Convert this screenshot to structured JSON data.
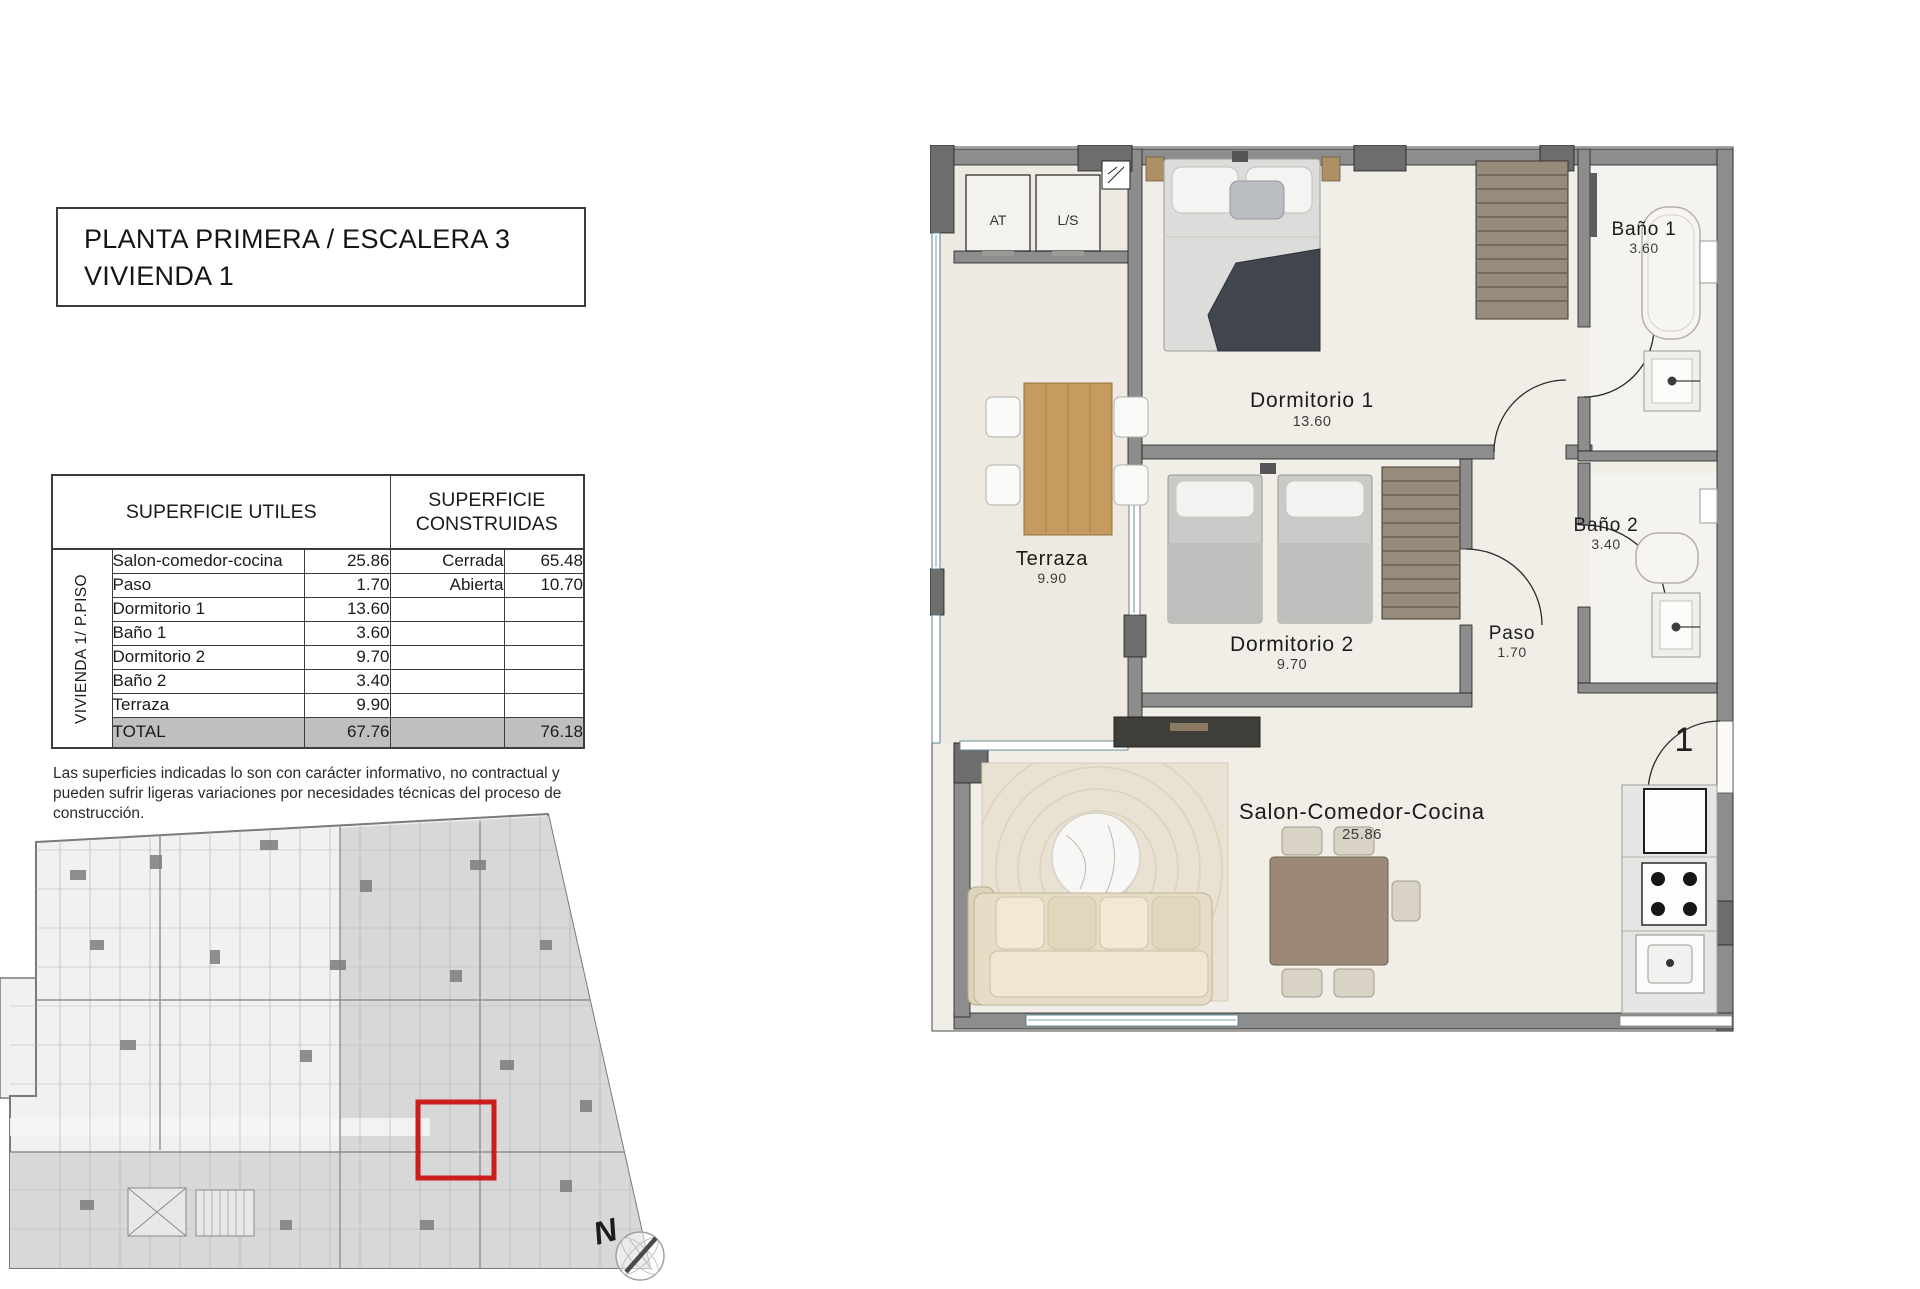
{
  "header": {
    "title_line1": "PLANTA PRIMERA / ESCALERA 3",
    "title_line2": "VIVIENDA 1"
  },
  "surfaces_table": {
    "utiles_header": "SUPERFICIE UTILES",
    "construidas_header": "SUPERFICIE CONSTRUIDAS",
    "group_label": "VIVIENDA 1/ P.PISO",
    "utiles_rows": [
      {
        "name": "Salon-comedor-cocina",
        "value": "25.86"
      },
      {
        "name": "Paso",
        "value": "1.70"
      },
      {
        "name": "Dormitorio 1",
        "value": "13.60"
      },
      {
        "name": "Baño 1",
        "value": "3.60"
      },
      {
        "name": "Dormitorio 2",
        "value": "9.70"
      },
      {
        "name": "Baño 2",
        "value": "3.40"
      },
      {
        "name": "Terraza",
        "value": "9.90"
      }
    ],
    "construidas_rows": [
      {
        "name": "Cerrada",
        "value": "65.48"
      },
      {
        "name": "Abierta",
        "value": "10.70"
      }
    ],
    "total": {
      "label": "TOTAL",
      "utiles": "67.76",
      "construidas": "76.18"
    }
  },
  "disclaimer": "Las superficies indicadas lo son con carácter informativo, no contractual y pueden sufrir ligeras variaciones por necesidades técnicas del proceso de construcción.",
  "floorplan": {
    "rooms": [
      {
        "name": "Dormitorio 1",
        "area": "13.60"
      },
      {
        "name": "Baño 1",
        "area": "3.60"
      },
      {
        "name": "Terraza",
        "area": "9.90"
      },
      {
        "name": "Dormitorio 2",
        "area": "9.70"
      },
      {
        "name": "Baño 2",
        "area": "3.40"
      },
      {
        "name": "Paso",
        "area": "1.70"
      },
      {
        "name": "Salon-Comedor-Cocina",
        "area": "25.86"
      }
    ],
    "closets": {
      "left": "AT",
      "right": "L/S"
    },
    "unit_number": "1"
  },
  "siteplan": {
    "north_label": "N",
    "highlight_color": "#cc1d1d"
  },
  "colors": {
    "wall": "#8d8d8d",
    "pillar": "#6d6d6d",
    "glass": "#55808e",
    "accent_red": "#cc1d1d",
    "total_row_bg": "#bfbfbf"
  }
}
